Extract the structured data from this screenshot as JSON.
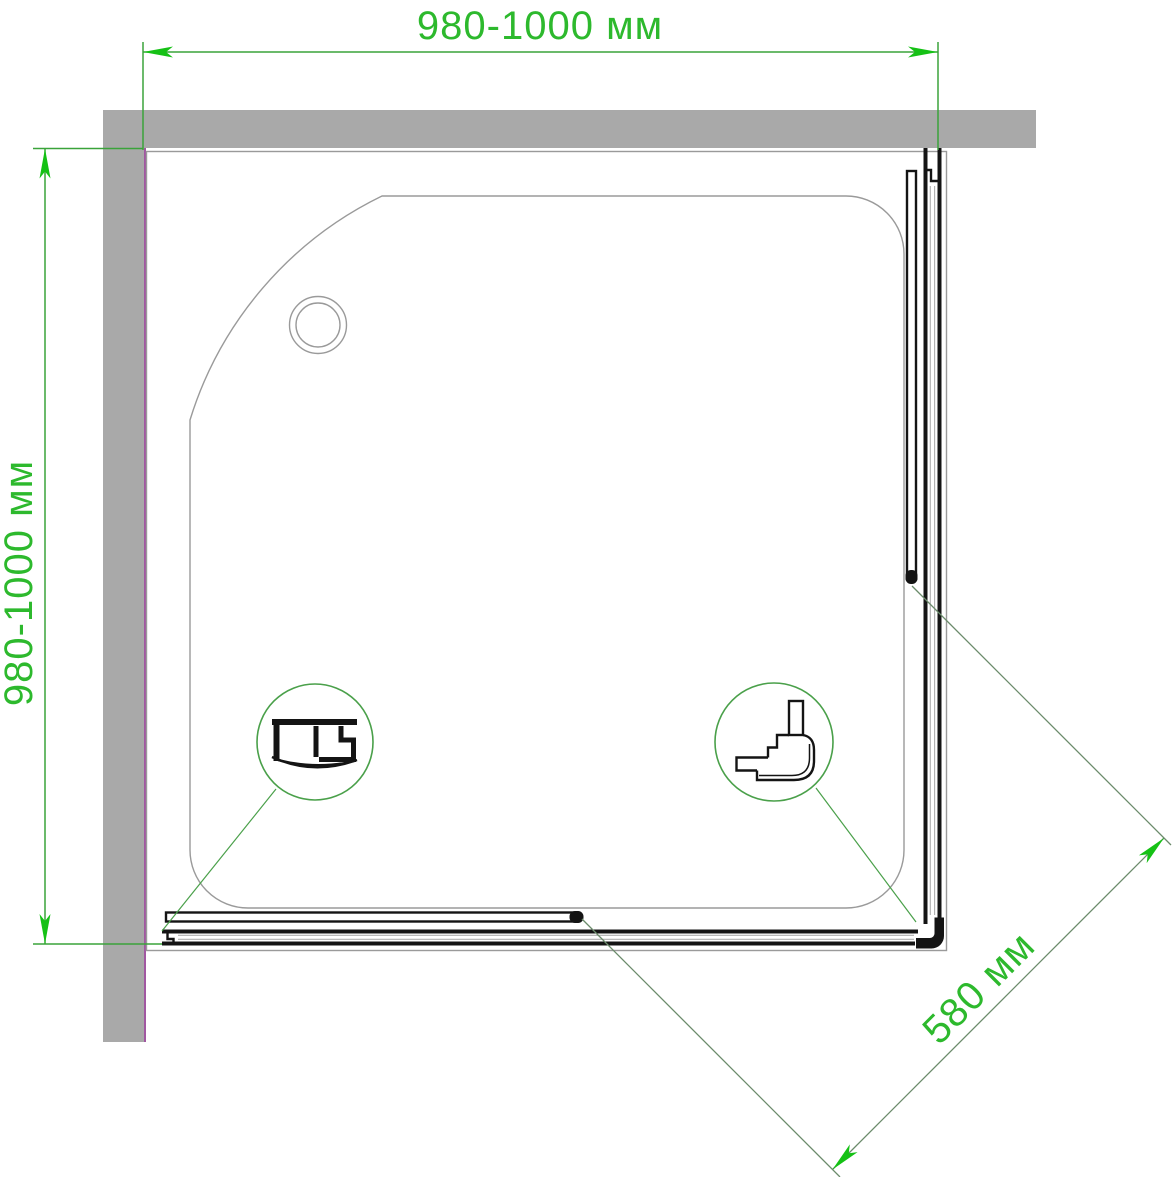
{
  "dimensions": {
    "width": {
      "label": "980-1000 мм"
    },
    "depth": {
      "label": "980-1000 мм"
    },
    "entry": {
      "label": "580 мм"
    }
  },
  "colors": {
    "dim_text": "#2db92d",
    "dim_line": "#3aa33a",
    "diag_line": "#6b8b6b",
    "leader": "#4aa04a",
    "arrow": "#15c115",
    "wall_fill": "#a9a9a9",
    "wall_edge": "#a157a1",
    "outline": "#9a9a9a",
    "profile": "#141414"
  }
}
